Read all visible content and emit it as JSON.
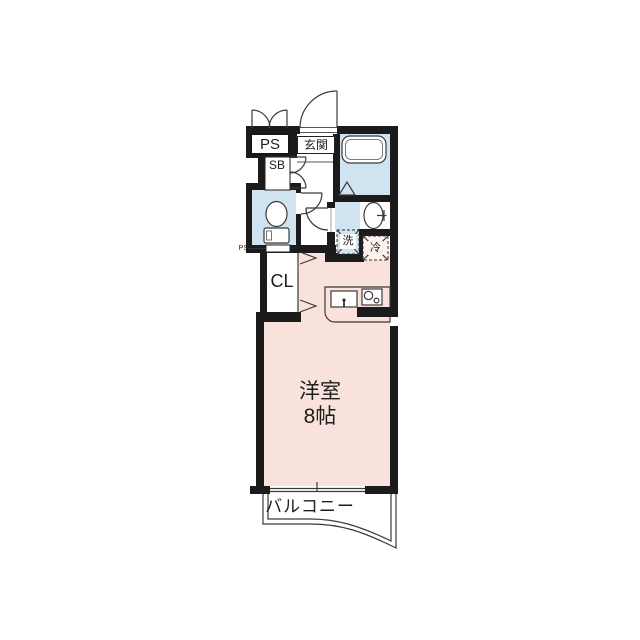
{
  "plan": {
    "type": "apartment-floor-plan",
    "areas": {
      "pipe_space": "PS",
      "entrance": "玄関",
      "shoe_box": "SB",
      "closet": "CL",
      "washer": "洗",
      "fridge": "冷",
      "pipe_space_small": "PS",
      "room_name": "洋室",
      "room_size": "8帖",
      "balcony": "バルコニー"
    },
    "colors": {
      "wall": "#1b1b1b",
      "room_pink": "#f9e2dc",
      "wet_blue": "#cfe3f0",
      "fridge_fill": "#fdf2ee",
      "line": "#3a3a3a"
    }
  }
}
